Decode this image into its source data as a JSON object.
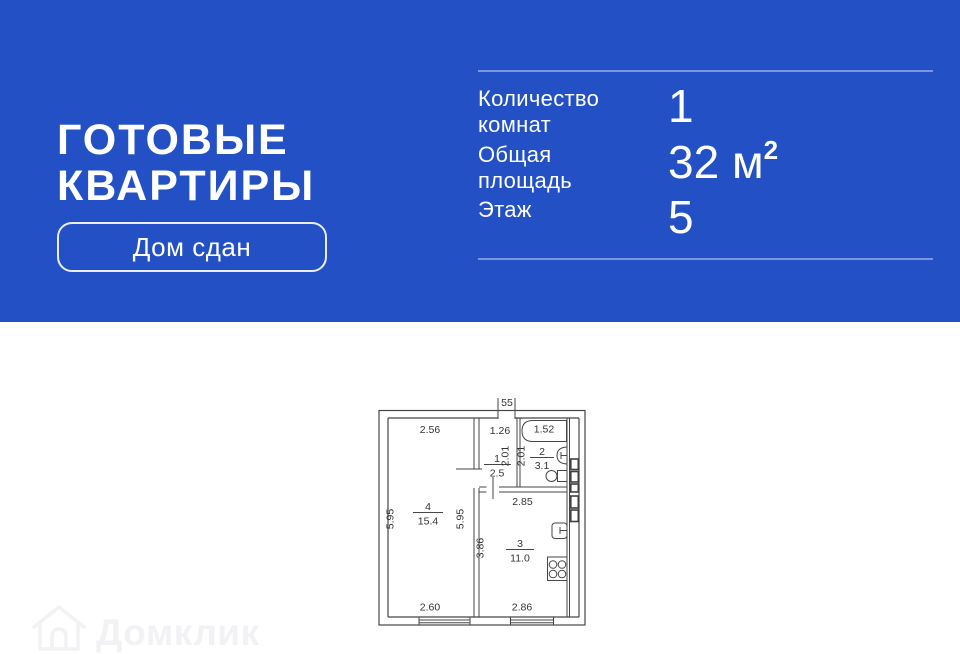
{
  "colors": {
    "banner_bg": "#2351C5"
  },
  "banner": {
    "title": "ГОТОВЫЕ\nКВАРТИРЫ",
    "badge_label": "Дом сдан",
    "stats": [
      {
        "label": "Количество\nкомнат",
        "value": "1",
        "unit": "",
        "sup": ""
      },
      {
        "label": "Общая\nплощадь",
        "value": "32",
        "unit": " м",
        "sup": "2"
      },
      {
        "label": "Этаж",
        "value": "5",
        "unit": "",
        "sup": ""
      }
    ]
  },
  "floorplan": {
    "entrance_label": "55",
    "room1": {
      "number": "1",
      "area": "2.5",
      "top": "1.26",
      "right": "2.01"
    },
    "room2": {
      "number": "2",
      "area": "3.1",
      "top": "1.52",
      "left": "2.01"
    },
    "room3": {
      "number": "3",
      "area": "11.0",
      "top": "2.85",
      "left": "3.86",
      "bottom": "2.86"
    },
    "room4": {
      "number": "4",
      "area": "15.4",
      "top": "2.56",
      "left": "5.95",
      "right": "5.95",
      "bottom": "2.60"
    }
  },
  "watermark": {
    "text": "Домклик"
  }
}
